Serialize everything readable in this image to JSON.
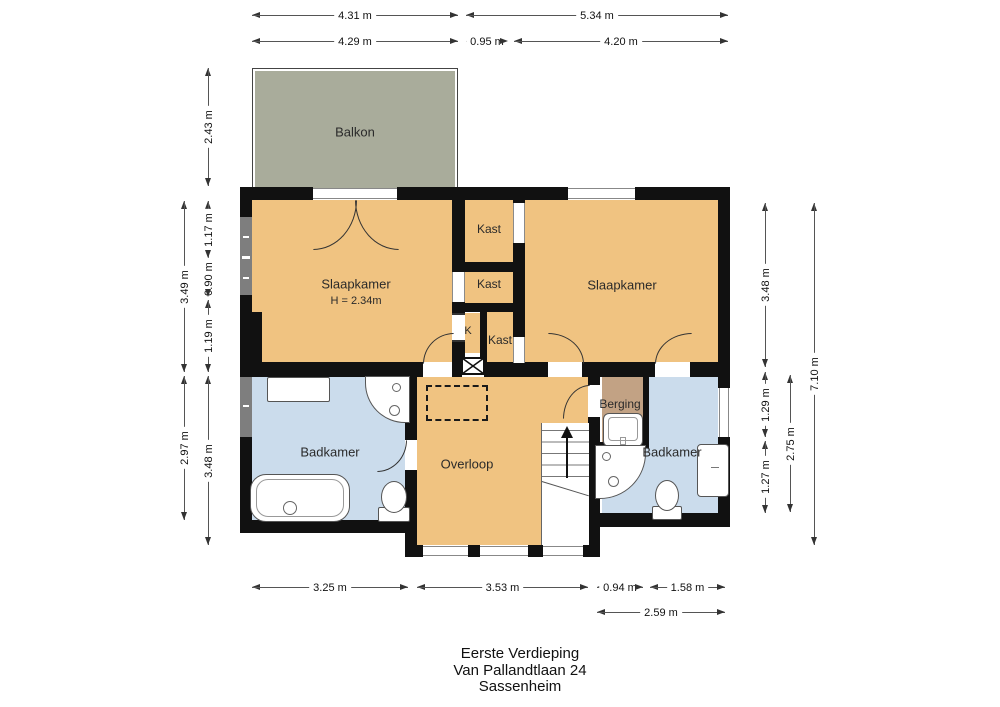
{
  "plan": {
    "rooms": {
      "balkon": {
        "label": "Balkon"
      },
      "slaapkamer_left": {
        "label": "Slaapkamer",
        "ceiling_height": "H = 2.34m"
      },
      "slaapkamer_right": {
        "label": "Slaapkamer"
      },
      "kast_top": {
        "label": "Kast"
      },
      "kast_middle": {
        "label": "Kast"
      },
      "kast_bottom": {
        "label": "Kast"
      },
      "kast_small": {
        "label": "K"
      },
      "badkamer_left": {
        "label": "Badkamer"
      },
      "badkamer_right": {
        "label": "Badkamer"
      },
      "overloop": {
        "label": "Overloop"
      },
      "berging": {
        "label": "Berging"
      }
    },
    "colors": {
      "room_orange": "#f0c381",
      "room_blue": "#cbdcec",
      "balkon_green": "#a9ac9b",
      "berging_tan": "#c2a284",
      "wall": "#111111"
    },
    "dimensions": {
      "top_row1": [
        "4.31 m",
        "5.34 m"
      ],
      "top_row2": [
        "4.29 m",
        "0.95 m",
        "4.20 m"
      ],
      "left": [
        "2.43 m",
        "3.49 m",
        "1.17 m",
        "0.90 m",
        "1.19 m",
        "2.97 m",
        "3.48 m"
      ],
      "right": [
        "3.48 m",
        "1.29 m",
        "1.27 m",
        "2.75 m",
        "7.10 m"
      ],
      "bottom_row1": [
        "3.25 m",
        "3.53 m",
        "0.94 m",
        "1.58 m"
      ],
      "bottom_row2": [
        "2.59 m"
      ]
    },
    "footer": {
      "line1": "Eerste Verdieping",
      "line2": "Van Pallandtlaan 24",
      "line3": "Sassenheim"
    }
  }
}
